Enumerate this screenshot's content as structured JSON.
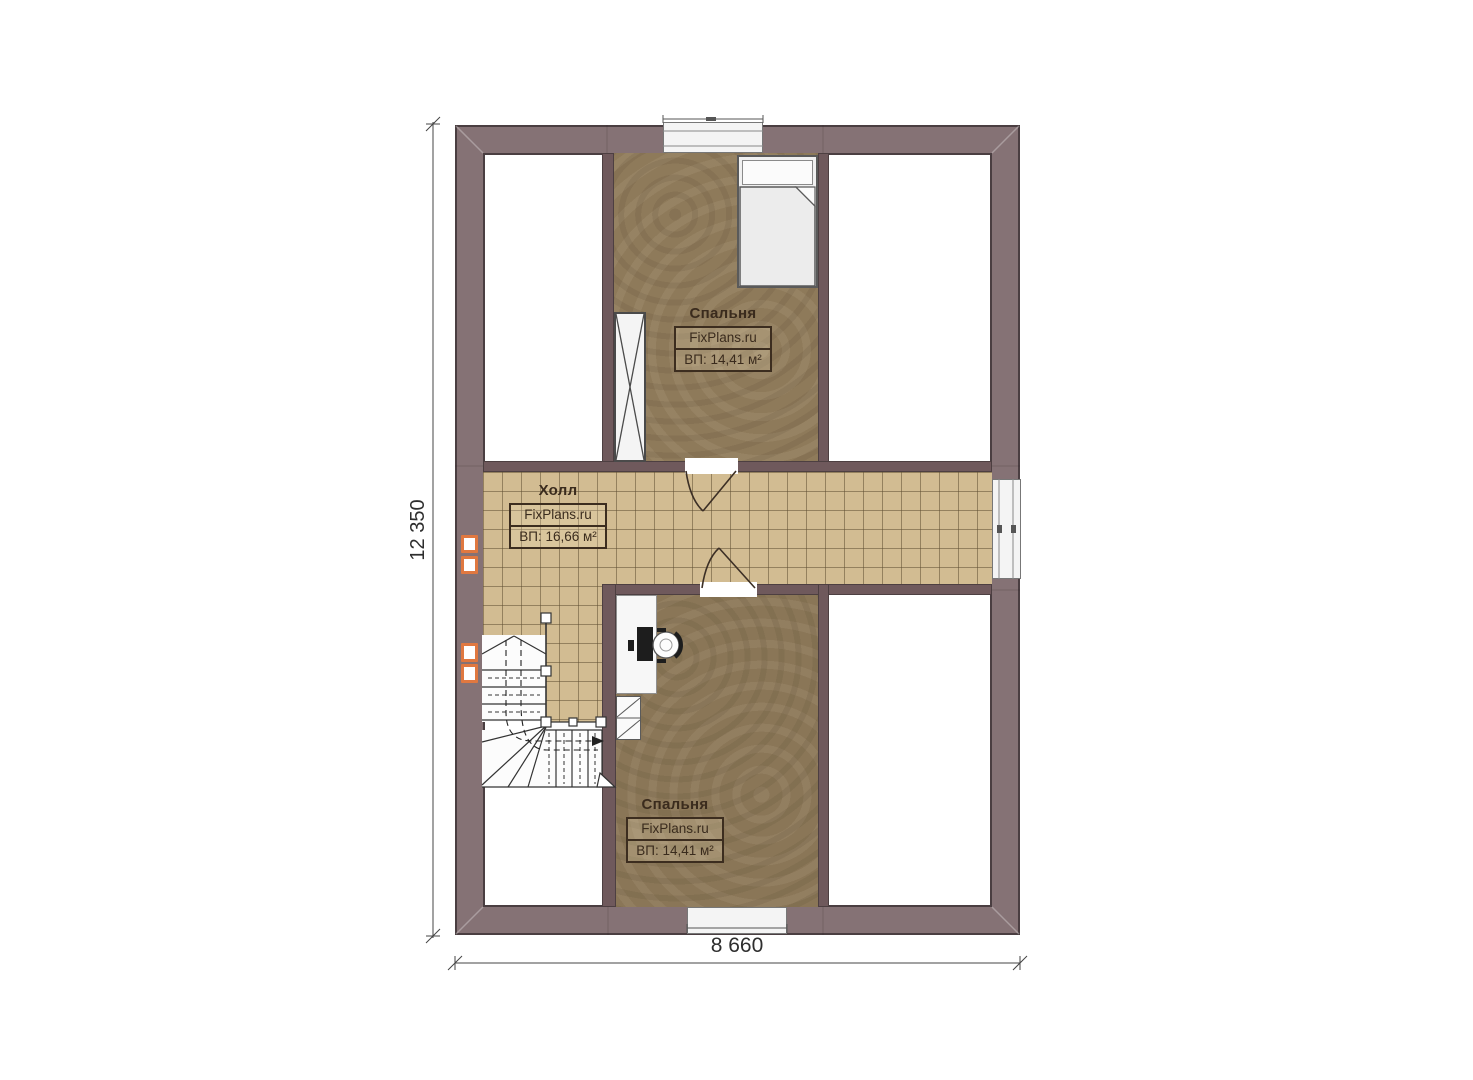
{
  "plan": {
    "brand": "FixPlans.ru",
    "rooms": {
      "bedroom_top": {
        "name": "Спальня",
        "area": "ВП: 14,41 м²"
      },
      "hall": {
        "name": "Холл",
        "area": "ВП: 16,66 м²"
      },
      "bedroom_bottom": {
        "name": "Спальня",
        "area": "ВП: 14,41 м²"
      }
    },
    "dimensions": {
      "height": "12 350",
      "width": "8 660"
    },
    "colors": {
      "exterior_wall": "#857275",
      "partition": "#6f595c",
      "hall_tile": "#d2bc92",
      "bedroom_floor": "#8e7a5a",
      "marker_accent": "#e07840"
    }
  }
}
